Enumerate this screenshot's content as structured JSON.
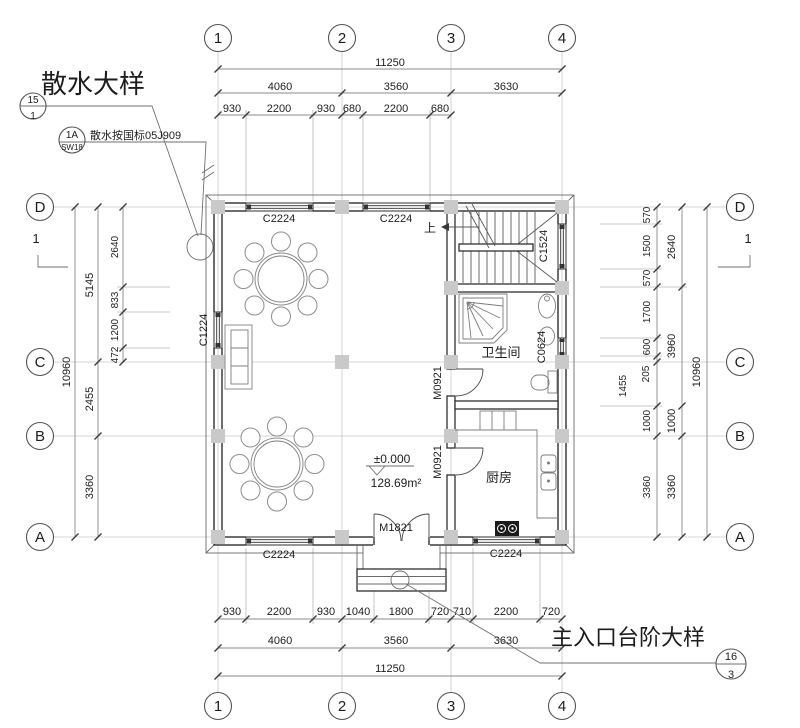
{
  "callouts": {
    "sanshui_title": "散水大样",
    "sanshui_ref": {
      "no": "15",
      "sheet": "1"
    },
    "sanshui_note": "散水按国标05J909",
    "note_ref": {
      "no": "1A",
      "sheet": "SW18"
    },
    "entrance_title": "主入口台阶大样",
    "entrance_ref": {
      "no": "16",
      "sheet": "3"
    }
  },
  "grid": {
    "cols": [
      "1",
      "2",
      "3",
      "4"
    ],
    "rows": [
      "D",
      "C",
      "B",
      "A"
    ],
    "section_mark": "1"
  },
  "rooms": {
    "bathroom": "卫生间",
    "kitchen": "厨房"
  },
  "levels": {
    "floor_level": "±0.000",
    "area": "128.69m²",
    "stair_up": "上"
  },
  "windows": {
    "c2224": "C2224",
    "c1224": "C1224",
    "c1524": "C1524",
    "c0624": "C0624"
  },
  "doors": {
    "m0921": "M0921",
    "m1821": "M1821"
  },
  "dims": {
    "top": {
      "total": "11250",
      "spans": [
        "4060",
        "3560",
        "3630"
      ],
      "detail": [
        "930",
        "2200",
        "930",
        "680",
        "2200",
        "680"
      ]
    },
    "bottom": {
      "total": "11250",
      "spans": [
        "4060",
        "3560",
        "3630"
      ],
      "detail": [
        "930",
        "2200",
        "930",
        "1040",
        "1800",
        "720",
        "710",
        "2200",
        "720"
      ]
    },
    "left": {
      "total": "10960",
      "spans": [
        "5145",
        "2455",
        "3360"
      ],
      "detail": [
        "2640",
        "833",
        "1200",
        "472"
      ]
    },
    "right": {
      "total": "10960",
      "spans": [
        "2640",
        "3960",
        "1000",
        "3360"
      ],
      "detail": [
        "570",
        "1500",
        "570",
        "1700",
        "600",
        "205",
        "1455",
        "1000",
        "3360"
      ]
    }
  }
}
